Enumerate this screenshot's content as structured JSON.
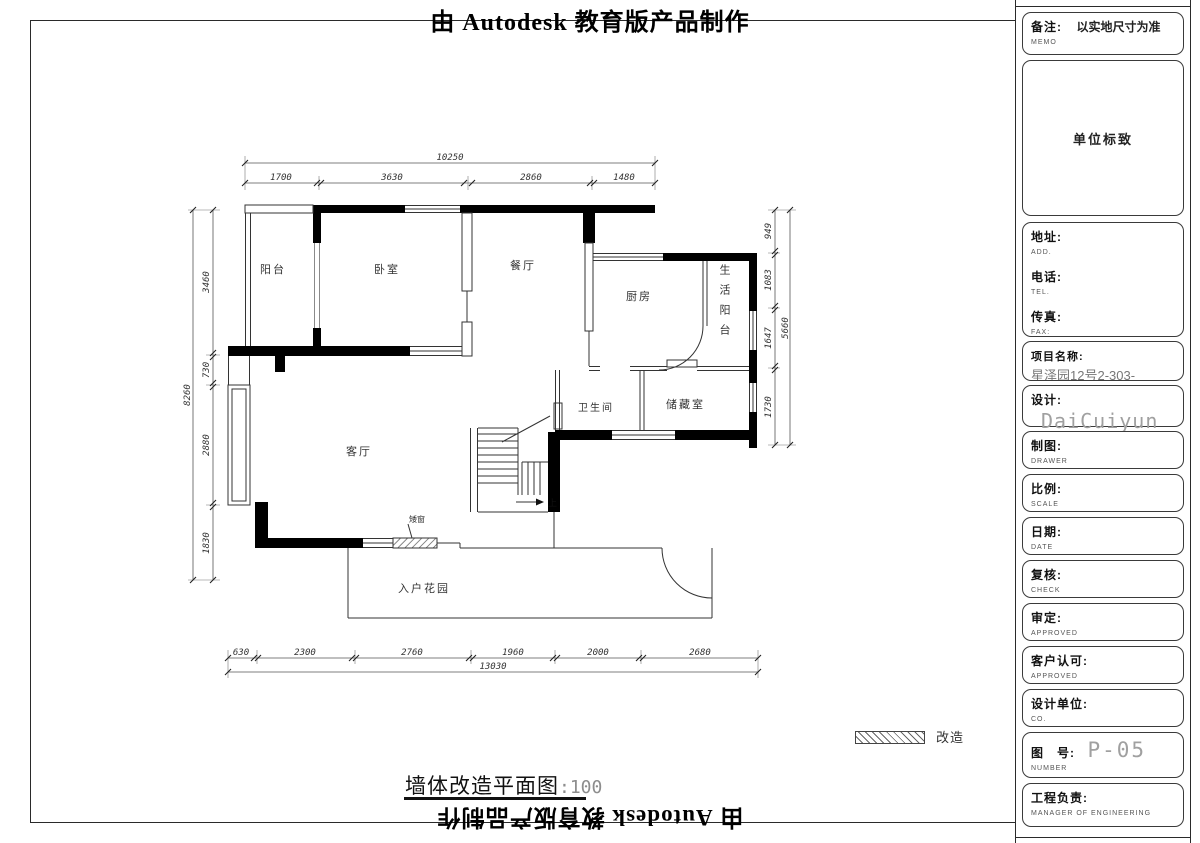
{
  "banner": {
    "top_text": "由 Autodesk 教育版产品制作",
    "bottom_text": "由 Autodesk 教育版产品制作"
  },
  "plan": {
    "rooms": {
      "balcony": "阳台",
      "bedroom": "卧室",
      "dining": "餐厅",
      "kitchen": "厨房",
      "utility_balcony": "生活阳台",
      "bathroom": "卫生间",
      "storage": "储藏室",
      "living": "客厅",
      "entry_garden": "入户花园"
    },
    "stairs": {
      "up_label": "上"
    },
    "notes": {
      "window_note": "矮窗"
    },
    "dims": {
      "top_total": "10250",
      "top": [
        "1700",
        "3630",
        "2860",
        "1480"
      ],
      "left_total": "8260",
      "left": [
        "3460",
        "730",
        "2880",
        "1830"
      ],
      "right_total": "5660",
      "right": [
        "949",
        "1083",
        "1647",
        "1730"
      ],
      "bottom_total": "13030",
      "bottom": [
        "630",
        "2300",
        "2760",
        "1960",
        "2000",
        "2680"
      ]
    }
  },
  "legend": {
    "modified_label": "改造"
  },
  "caption": {
    "title": "墙体改造平面图",
    "scale": ":100"
  },
  "titleblock": {
    "memo": {
      "label": "备注:",
      "sub": "MEMO",
      "value": "以实地尺寸为准"
    },
    "logo": {
      "value": "单位标致"
    },
    "address": {
      "label": "地址:",
      "sub": "ADD."
    },
    "phone": {
      "label": "电话:",
      "sub": "TEL."
    },
    "fax": {
      "label": "传真:",
      "sub": "FAX:"
    },
    "project": {
      "label": "项目名称:",
      "sub": "PROJECT",
      "value": "星泽园12号2-303-"
    },
    "designer": {
      "label": "设计:",
      "sub": "DESIGNER",
      "value": "DaiCuiyun"
    },
    "drawer": {
      "label": "制图:",
      "sub": "DRAWER"
    },
    "scale": {
      "label": "比例:",
      "sub": "SCALE"
    },
    "date": {
      "label": "日期:",
      "sub": "DATE"
    },
    "check": {
      "label": "复核:",
      "sub": "CHECK"
    },
    "approved": {
      "label": "审定:",
      "sub": "APPROVED"
    },
    "client": {
      "label": "客户认可:",
      "sub": "APPROVED"
    },
    "company": {
      "label": "设计单位:",
      "sub": "CO."
    },
    "number": {
      "label": "图　号:",
      "sub": "NUMBER",
      "value": "P-05"
    },
    "manager": {
      "label": "工程负责:",
      "sub": "MANAGER OF ENGINEERING"
    }
  }
}
